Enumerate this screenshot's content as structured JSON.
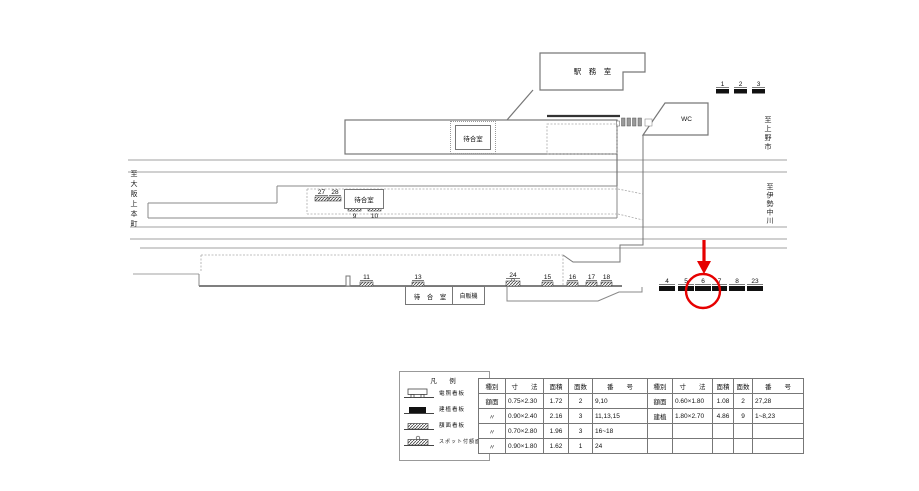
{
  "colors": {
    "annotation_red": "#e60000",
    "track_gray": "#a0a0a0",
    "outline_gray": "#777777"
  },
  "rooms": {
    "station_office": "駅　務　室",
    "waiting_room_main": "待合室",
    "wc": "WC",
    "waiting_room_platform": "待合室",
    "waiting_room_bottom": "待　合　室",
    "vending_machine": "自販機"
  },
  "directions": {
    "to_uenoshi": "至上野市",
    "to_ise_nakagawa": "至伊勢中川",
    "to_osaka_uehommachi": "至大阪上本町"
  },
  "signs": {
    "top": [
      "1",
      "2",
      "3"
    ],
    "middle_upper": [
      "27",
      "28"
    ],
    "middle_lower": [
      "9",
      "10"
    ],
    "bottom_platform": [
      "11",
      "13",
      "24",
      "15",
      "16",
      "17",
      "18"
    ],
    "bottom_right": [
      "4",
      "5",
      "6",
      "7",
      "8",
      "23"
    ]
  },
  "legend": {
    "title": "凡　例",
    "items": [
      {
        "label": "電照看板"
      },
      {
        "label": "建植看板"
      },
      {
        "label": "額面看板"
      },
      {
        "label": "スポット付額面"
      }
    ]
  },
  "spec_table": {
    "headers": [
      "種別",
      "寸　　法",
      "面積",
      "面数",
      "番　　号",
      "種別",
      "寸　　法",
      "面積",
      "面数",
      "番　　号"
    ],
    "rows": [
      [
        "額面",
        "0.75×2.30",
        "1.72",
        "2",
        "9,10",
        "額面",
        "0.60×1.80",
        "1.08",
        "2",
        "27,28"
      ],
      [
        "〃",
        "0.90×2.40",
        "2.16",
        "3",
        "11,13,15",
        "建植",
        "1.80×2.70",
        "4.86",
        "9",
        "1~8,23"
      ],
      [
        "〃",
        "0.70×2.80",
        "1.96",
        "3",
        "16~18",
        "",
        "",
        "",
        "",
        ""
      ],
      [
        "〃",
        "0.90×1.80",
        "1.62",
        "1",
        "24",
        "",
        "",
        "",
        "",
        ""
      ]
    ]
  }
}
